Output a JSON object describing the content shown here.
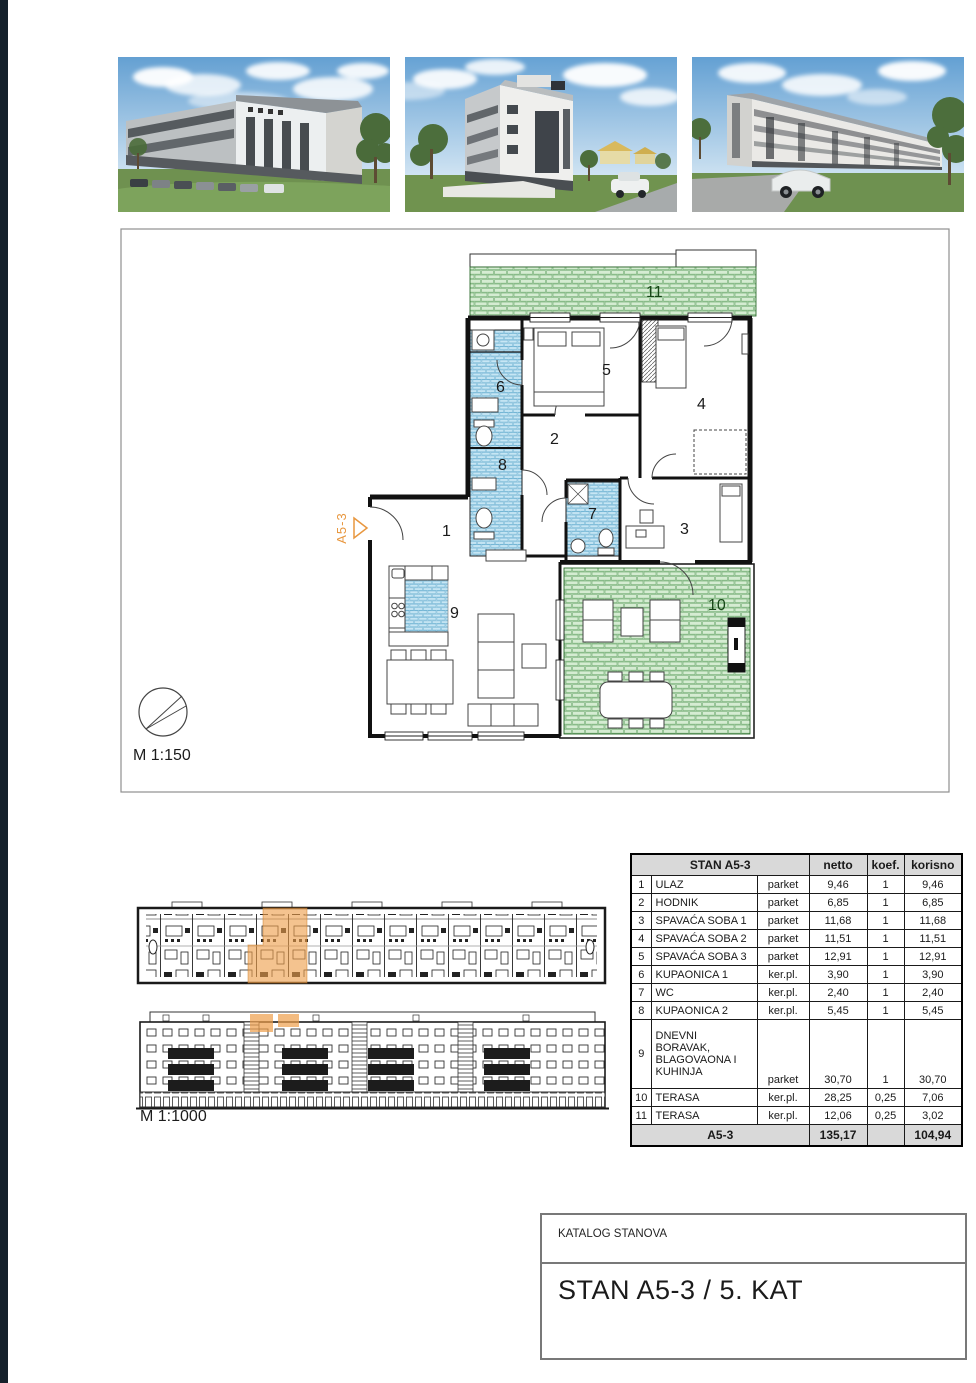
{
  "floorplan": {
    "scale_label": "M 1:150",
    "marker_label": "A5-3",
    "room_numbers": [
      "1",
      "2",
      "3",
      "4",
      "5",
      "6",
      "7",
      "8",
      "9",
      "10",
      "11"
    ]
  },
  "siteplan": {
    "scale_label": "M 1:1000"
  },
  "area_table": {
    "title": "STAN A5-3",
    "col_netto": "netto",
    "col_koef": "koef.",
    "col_korisno": "korisno",
    "rows": [
      {
        "num": "1",
        "name": "ULAZ",
        "finish": "parket",
        "netto": "9,46",
        "koef": "1",
        "korisno": "9,46"
      },
      {
        "num": "2",
        "name": "HODNIK",
        "finish": "parket",
        "netto": "6,85",
        "koef": "1",
        "korisno": "6,85"
      },
      {
        "num": "3",
        "name": "SPAVAĆA SOBA 1",
        "finish": "parket",
        "netto": "11,68",
        "koef": "1",
        "korisno": "11,68"
      },
      {
        "num": "4",
        "name": "SPAVAĆA SOBA 2",
        "finish": "parket",
        "netto": "11,51",
        "koef": "1",
        "korisno": "11,51"
      },
      {
        "num": "5",
        "name": "SPAVAĆA SOBA 3",
        "finish": "parket",
        "netto": "12,91",
        "koef": "1",
        "korisno": "12,91"
      },
      {
        "num": "6",
        "name": "KUPAONICA 1",
        "finish": "ker.pl.",
        "netto": "3,90",
        "koef": "1",
        "korisno": "3,90"
      },
      {
        "num": "7",
        "name": "WC",
        "finish": "ker.pl.",
        "netto": "2,40",
        "koef": "1",
        "korisno": "2,40"
      },
      {
        "num": "8",
        "name": "KUPAONICA 2",
        "finish": "ker.pl.",
        "netto": "5,45",
        "koef": "1",
        "korisno": "5,45"
      },
      {
        "num": "9",
        "name": "DNEVNI\nBORAVAK,\nBLAGOVAONA I\nKUHINJA",
        "finish": "parket",
        "netto": "30,70",
        "koef": "1",
        "korisno": "30,70"
      },
      {
        "num": "10",
        "name": "TERASA",
        "finish": "ker.pl.",
        "netto": "28,25",
        "koef": "0,25",
        "korisno": "7,06"
      },
      {
        "num": "11",
        "name": "TERASA",
        "finish": "ker.pl.",
        "netto": "12,06",
        "koef": "0,25",
        "korisno": "3,02"
      }
    ],
    "total_label": "A5-3",
    "total_netto": "135,17",
    "total_korisno": "104,94"
  },
  "title_block": {
    "catalog_label": "KATALOG STANOVA",
    "title": "STAN A5-3 / 5. KAT"
  },
  "colors": {
    "accent_orange": "#eda05a",
    "terrace_green": "#d5ecd2",
    "tile_blue": "#cde9f6",
    "table_header_gray": "#d9d9d9"
  }
}
